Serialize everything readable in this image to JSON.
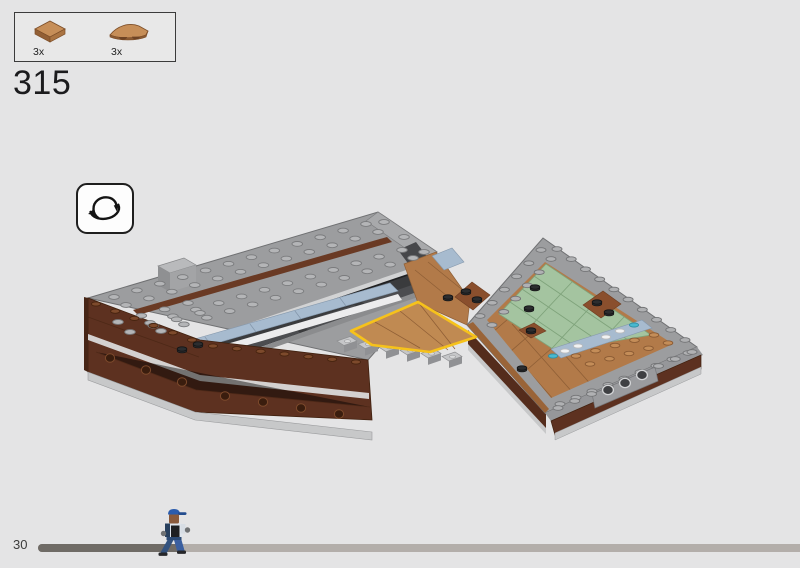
{
  "page": {
    "background_color": "#e4e4e5",
    "page_number": "30"
  },
  "step": {
    "number": "315"
  },
  "parts_box": {
    "parts": [
      {
        "quantity": "3x",
        "piece": "tile-2x2-medium-nougat",
        "color": "#c68e58"
      },
      {
        "quantity": "3x",
        "piece": "curved-wedge-plate-medium-nougat",
        "color": "#c68e58"
      }
    ]
  },
  "rotate_hint": {
    "icon": "rotate-model-3d-icon"
  },
  "model": {
    "highlight_color": "#f6c21b",
    "palette": {
      "reddish_brown_wall": "#5d3120",
      "medium_nougat": "#b27a49",
      "sand_green_tiles": "#a4c4a0",
      "sand_blue_tiles": "#a7bbcf",
      "plate_gray": "#9c9d9f",
      "channel_dark_gray": "#3a3b3d",
      "base_light_gray": "#c7c8c9"
    }
  },
  "progress": {
    "fill_width": "19%",
    "track_color": "#b3aeaa",
    "fill_color": "#6f6b66",
    "walker_icon": "walking-minifigure-icon"
  }
}
